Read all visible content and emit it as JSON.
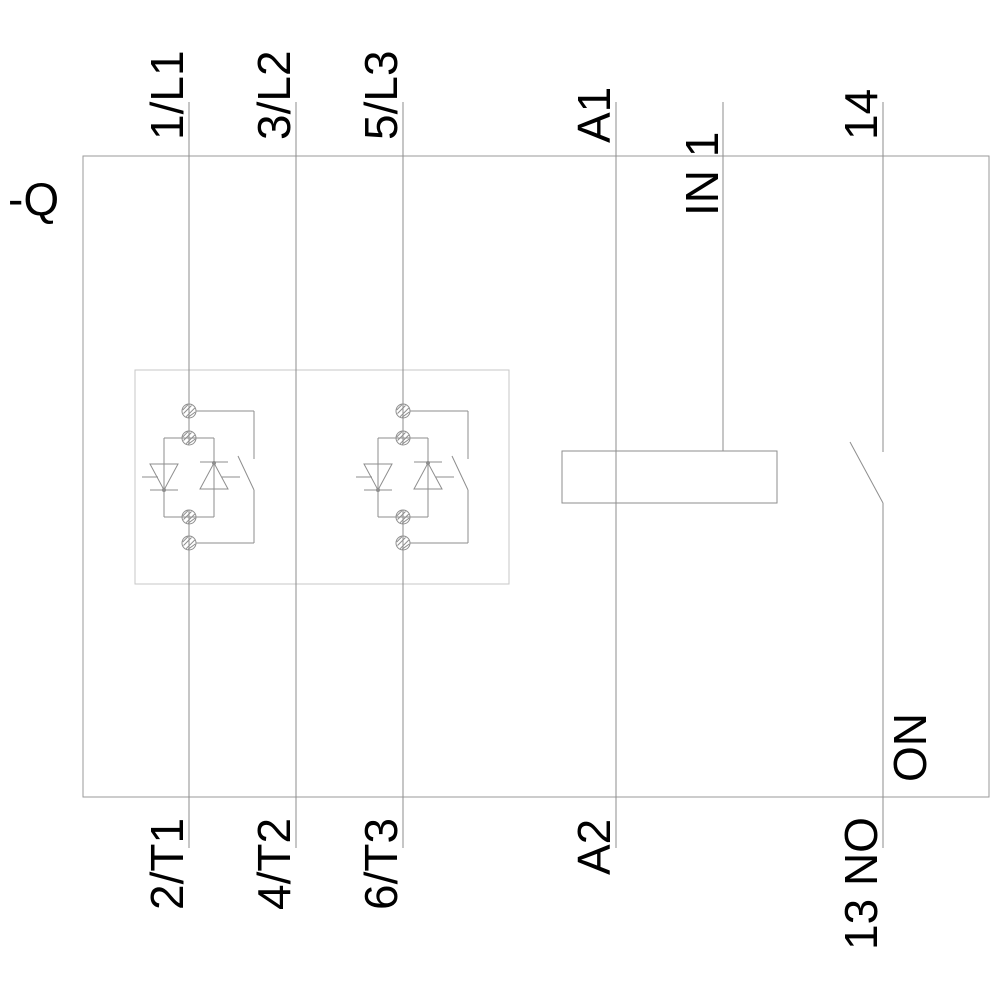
{
  "diagram": {
    "type": "electrical-schematic-soft-starter",
    "device_designator": "-Q",
    "labels": {
      "q": "-Q",
      "l1": "1/L1",
      "l2": "3/L2",
      "l3": "5/L3",
      "a1": "A1",
      "in1": "IN 1",
      "t14": "14",
      "t1": "2/T1",
      "t2": "4/T2",
      "t3": "6/T3",
      "a2": "A2",
      "no13": "13 NO",
      "on": "ON"
    },
    "top_terminals": [
      "1/L1",
      "3/L2",
      "5/L3",
      "A1",
      "IN 1",
      "14"
    ],
    "bottom_terminals": [
      "2/T1",
      "4/T2",
      "6/T3",
      "A2",
      "13 NO"
    ],
    "colors": {
      "wire": "#8e8e8e",
      "frame": "#9a9a9a",
      "module": "#c7c7c7",
      "text": "#000000",
      "background": "#ffffff"
    }
  }
}
